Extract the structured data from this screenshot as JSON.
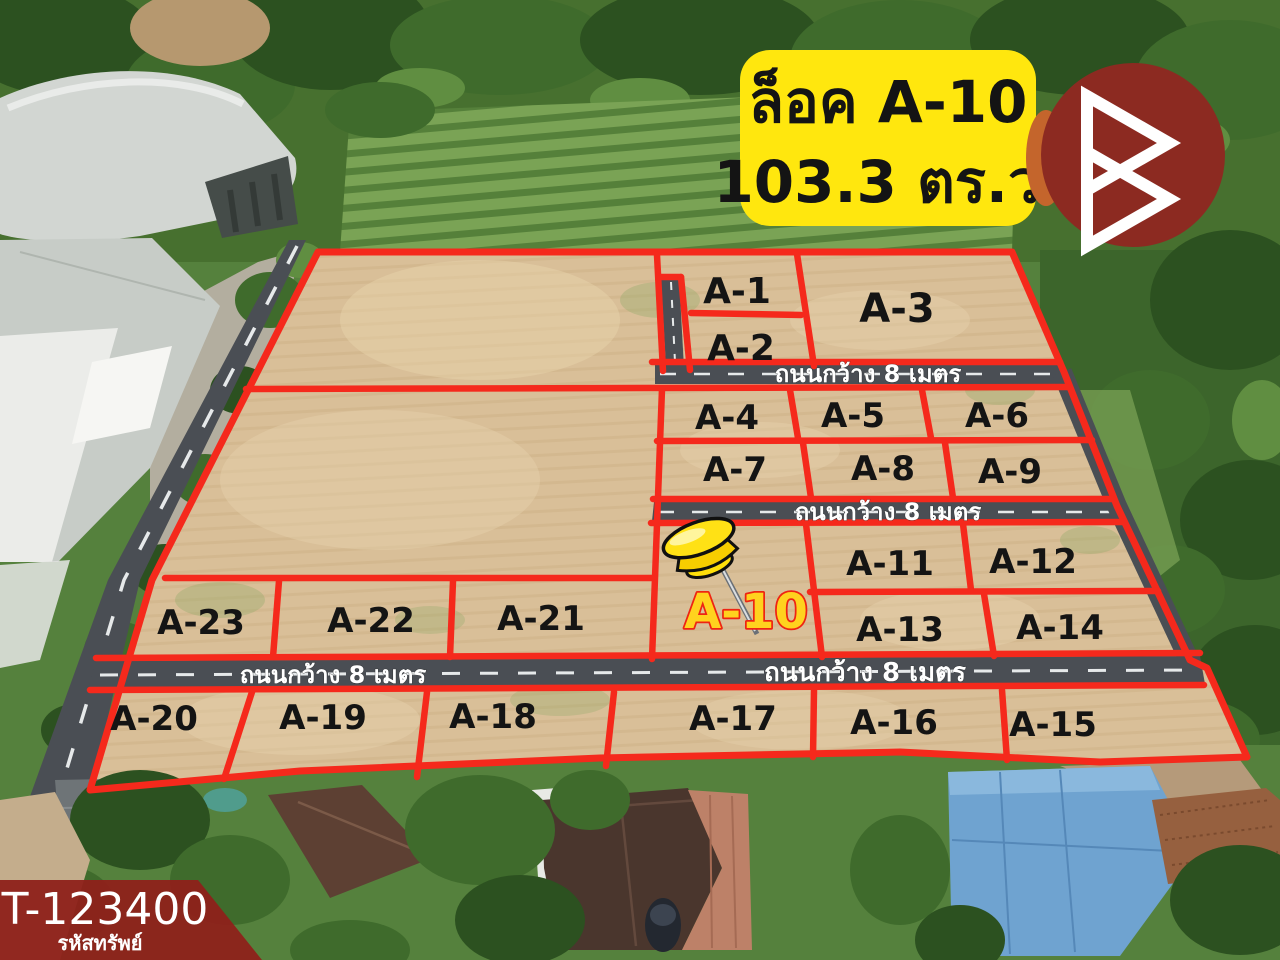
{
  "banner": {
    "line1": "ล็อค A-10",
    "line2": "103.3 ตร.ว."
  },
  "plots": [
    {
      "label": "A-1"
    },
    {
      "label": "A-2"
    },
    {
      "label": "A-3"
    },
    {
      "label": "A-4"
    },
    {
      "label": "A-5"
    },
    {
      "label": "A-6"
    },
    {
      "label": "A-7"
    },
    {
      "label": "A-8"
    },
    {
      "label": "A-9"
    },
    {
      "label": "A-10",
      "highlighted": true
    },
    {
      "label": "A-11"
    },
    {
      "label": "A-12"
    },
    {
      "label": "A-13"
    },
    {
      "label": "A-14"
    },
    {
      "label": "A-15"
    },
    {
      "label": "A-16"
    },
    {
      "label": "A-17"
    },
    {
      "label": "A-18"
    },
    {
      "label": "A-19"
    },
    {
      "label": "A-20"
    },
    {
      "label": "A-21"
    },
    {
      "label": "A-22"
    },
    {
      "label": "A-23"
    }
  ],
  "roads": {
    "width_label": "ถนนกว้าง 8 เมตร"
  },
  "highlight_plot": {
    "id": "A-10",
    "label_color": "#ffd21e",
    "outline_color": "#ee2412"
  },
  "property_code": {
    "code": "T-123400",
    "label": "รหัสทรัพย์"
  },
  "icons": {
    "pin": "pushpin-icon",
    "logo": "triangle-b-logo"
  },
  "colors": {
    "boundary_red": "#f5291c",
    "banner_yellow": "#ffe70e",
    "banner_text": "#141414",
    "logo_maroon": "#8c2a21",
    "badge_maroon": "#8e211a",
    "road_gray": "#4a4e54",
    "soil_tan": "#d9bf98"
  }
}
